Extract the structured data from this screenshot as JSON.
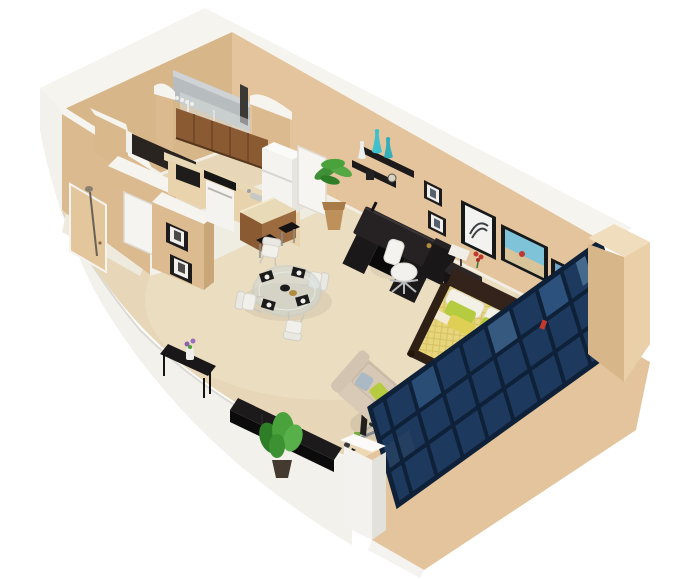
{
  "image": {
    "kind": "3d-floor-plan-render",
    "description": "Isometric cutaway 3D render of a studio apartment with kitchen, bathroom, and combined living/sleeping area",
    "width_px": 695,
    "height_px": 579
  },
  "palette": {
    "background": "#ffffff",
    "wall_tan": "#e3c49c",
    "wall_tan_dark": "#d7b68a",
    "wall_tan_light": "#e9d0a8",
    "wall_cap_white": "#f6f4ef",
    "outer_white": "#f2f1ec",
    "floor_carpet": "#e7d7b8",
    "floor_carpet_light": "#efe2c7",
    "tile_white": "#efece2",
    "wood_cabinet": "#8a5a33",
    "wood_cabinet_dark": "#6f4525",
    "counter_tan": "#e8d3ad",
    "appliance_white": "#f4f3f0",
    "navy_glazing": "#1d3a5e",
    "navy_frame_dark": "#0e2138",
    "navy_pane_light": "#2c517c",
    "black_furniture": "#1c1a1b",
    "sofa_beige": "#cdbfa9",
    "cushion_beige": "#d6c8b4",
    "bed_duvet_yellow": "#e7d67c",
    "headboard_brown": "#33231a",
    "pillow_lime": "#b5cc41",
    "pillow_yellow": "#e0cf55",
    "pillow_gray": "#aab9c4",
    "pillow_white": "#f3f0e6",
    "plant_green": "#49a23b",
    "plant_green_dark": "#2e7d27",
    "teal_vase": "#3ec1cc",
    "shower_gray": "#b7bcbf",
    "glass_gray": "#d8dcdd",
    "accent_red": "#c0392e",
    "chrome": "#b9bcbe",
    "door_tan": "#e4c69c",
    "brass": "#b08a3e"
  },
  "scene": {
    "rooms": [
      "living-sleeping-area",
      "kitchen",
      "bathroom",
      "entry-hall",
      "closet"
    ],
    "furniture": [
      "entry-door",
      "closet-door",
      "pantry-door",
      "shower",
      "upper-cabinets",
      "base-cabinets",
      "microwave",
      "oven",
      "refrigerator",
      "kitchen-island",
      "bar-stools",
      "dining-table",
      "dining-chairs",
      "console-table",
      "media-console",
      "floor-plant",
      "palm-plant",
      "exercise-machine",
      "sofa",
      "throw-pillows",
      "desk",
      "office-chair",
      "file-cabinet",
      "nightstand",
      "table-lamp",
      "bed",
      "headboard",
      "wall-shelves",
      "teal-vases",
      "framed-art-feather",
      "framed-art-beach",
      "framed-art-city",
      "small-frames",
      "french-door-window-wall"
    ]
  }
}
